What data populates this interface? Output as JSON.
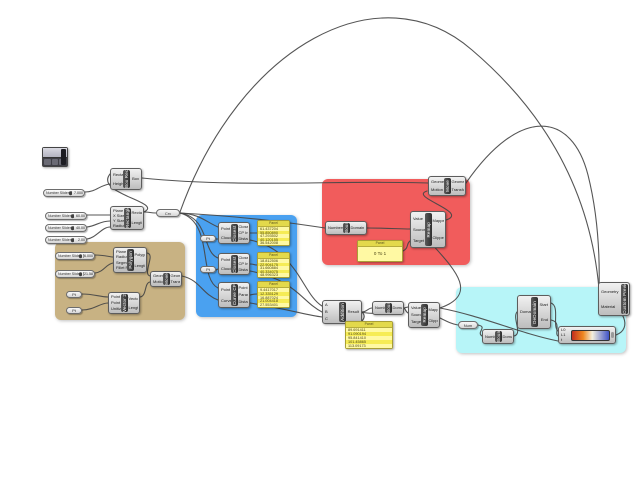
{
  "sliders": {
    "height": {
      "label": "Number Slider",
      "value": "7.000"
    },
    "xSize": {
      "label": "Number Slider",
      "value": "60.00"
    },
    "ySize": {
      "label": "Number Slider",
      "value": "40.00"
    },
    "radius": {
      "label": "Number Slider",
      "value": "2.00"
    },
    "polyRadius": {
      "label": "Number Slider",
      "value": "6.000"
    },
    "polySegments": {
      "label": "Number Slider",
      "value": "21.58"
    }
  },
  "components": {
    "boxRect": {
      "label": "Box Rectangle",
      "inputs": [
        "Rectangle",
        "Height"
      ],
      "outputs": [
        "Box"
      ]
    },
    "rectangle": {
      "label": "Rectangle",
      "inputs": [
        "Plane",
        "X Size",
        "Y Size",
        "Radius"
      ],
      "outputs": [
        "Rectangle",
        "Length"
      ]
    },
    "closestPoint1": {
      "label": "Closest Point",
      "inputs": [
        "Point",
        "Cloud"
      ],
      "outputs": [
        "Closest Point",
        "CP Index",
        "Distance"
      ]
    },
    "closestPoint2": {
      "label": "Closest Point",
      "inputs": [
        "Point",
        "Cloud"
      ],
      "outputs": [
        "Closest Point",
        "CP Index",
        "Distance"
      ]
    },
    "curveClosestPoint": {
      "label": "Curve CP",
      "inputs": [
        "Point",
        "Curve"
      ],
      "outputs": [
        "Point",
        "Parameter",
        "Distance"
      ]
    },
    "polygon": {
      "label": "Polygon",
      "inputs": [
        "Plane",
        "Radius",
        "Segments",
        "Fillet Radius"
      ],
      "outputs": [
        "Polygon",
        "Length"
      ]
    },
    "vector2pt": {
      "label": "Vector 2Pt",
      "inputs": [
        "Point A",
        "Point B",
        "Unitize"
      ],
      "outputs": [
        "Vector",
        "Length"
      ]
    },
    "moveTan": {
      "label": "Move",
      "inputs": [
        "Geometry",
        "Motion"
      ],
      "outputs": [
        "Geometry",
        "Transform"
      ]
    },
    "moveRed": {
      "label": "Move",
      "inputs": [
        "Geometry",
        "Motion"
      ],
      "outputs": [
        "Geometry",
        "Transform"
      ]
    },
    "boundsRed": {
      "label": "Bounds",
      "inputs": [
        "Numbers"
      ],
      "outputs": [
        "Domain"
      ]
    },
    "remapRed": {
      "label": "Remap",
      "inputs": [
        "Value",
        "Source",
        "Target"
      ],
      "outputs": [
        "Mapped",
        "Clipped"
      ]
    },
    "addition": {
      "label": "Addition",
      "inputs": [
        "A",
        "B",
        "C"
      ],
      "outputs": [
        "Result"
      ]
    },
    "boundsBottom": {
      "label": "Bounds",
      "inputs": [
        "Numbers"
      ],
      "outputs": [
        "Domain"
      ]
    },
    "remapBottom": {
      "label": "Remap",
      "inputs": [
        "Value",
        "Source",
        "Target"
      ],
      "outputs": [
        "Mapped",
        "Clipped"
      ]
    },
    "boundsCyan": {
      "label": "Bounds",
      "inputs": [
        "Numbers"
      ],
      "outputs": [
        "Domain"
      ]
    },
    "deconstructDomain": {
      "label": "DeDomain",
      "inputs": [
        "Domain"
      ],
      "outputs": [
        "Start",
        "End"
      ]
    },
    "gradient": {
      "label": "Gradient",
      "inputs": [
        "L0",
        "L1",
        "t"
      ],
      "outputs": []
    },
    "customPreview": {
      "label": "Custom Preview",
      "inputs": [
        "Geometry",
        "Material"
      ],
      "outputs": []
    }
  },
  "capsules": {
    "hub": "Crv",
    "pt1": "Pt",
    "pt2": "Pt",
    "ptA": "Pt",
    "ptB": "Pt",
    "num": "Num"
  },
  "panels": {
    "p1": {
      "title": "Panel",
      "rows": [
        "61.437204",
        "55.850890",
        "47.293502",
        "40.120155",
        "36.542008"
      ]
    },
    "p2": {
      "title": "Panel",
      "rows": [
        "18.812506",
        "22.904175",
        "31.660884",
        "40.334075",
        "48.996323"
      ]
    },
    "p3": {
      "title": "Panel",
      "rows": [
        "9.4417017",
        "12.335129",
        "16.887024",
        "21.004418",
        "27.553401"
      ]
    },
    "pRed": {
      "title": "Panel",
      "rows": [
        "0 To 1"
      ]
    },
    "pBottom": {
      "title": "Panel",
      "rows": [
        "89.691411",
        "91.090194",
        "95.841410",
        "101.45865",
        "113.09173"
      ]
    }
  },
  "colors": {
    "groupBlue": "#4aa1f0",
    "groupTan": "#c8b283",
    "groupRed": "#f15c5c",
    "groupCyan": "#b7f5f8",
    "panelYellow": "#fdf561",
    "wire": "#474747",
    "gradientLeft": "#c22d1e",
    "gradientMid": "#ee8820",
    "gradientRight": "#4054c8"
  }
}
